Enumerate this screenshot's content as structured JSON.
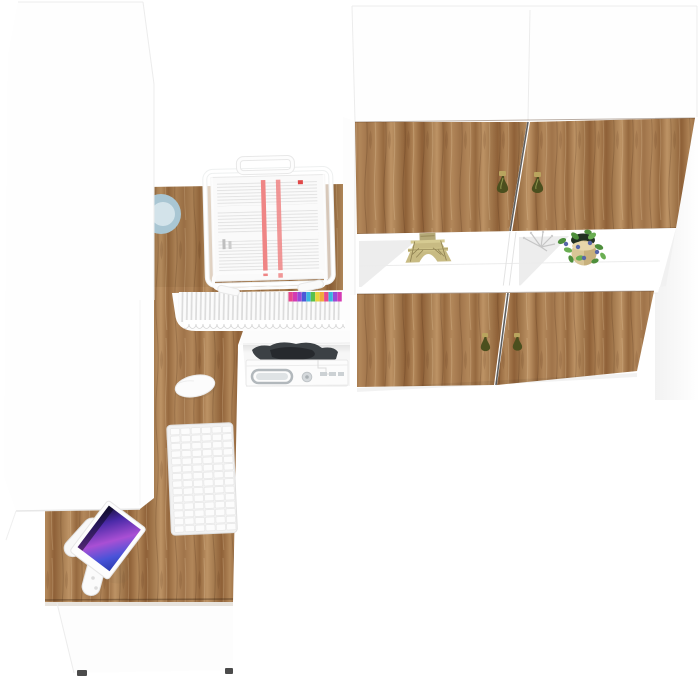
{
  "scene": {
    "description": "Top-down 3D product render of a white and oak home-office furniture set: corner desk with hutch, tall white cabinet and wall cabinet unit",
    "background": "#ffffff"
  },
  "colors": {
    "faintLine": "#ececec",
    "gapLine": "#5f5f5f",
    "handleBody": "#4b4f1e",
    "handleMount": "#b9a45e",
    "teal": "#a9c6d3",
    "tealInner": "#d3e3ea",
    "chair": "#3c4145",
    "chairDark": "#26292d",
    "metal": "#b2b8bc",
    "metalFill": "#dfe3e5",
    "redStripe": "#ef8585",
    "leaf": "#4e8f3c",
    "leaf2": "#6aae52",
    "berry": "#5766a8",
    "pot": "#d9c697",
    "potShade": "#c3ab77",
    "eiffel": "#c8bb83",
    "eiffelDark": "#8e8050",
    "foot": "#4b4b4b",
    "wire": "#c6c6c6"
  },
  "gradients": {
    "woodG": [
      {
        "o": 0,
        "c": "#a0744a"
      },
      {
        "o": 0.18,
        "c": "#b2875a"
      },
      {
        "o": 0.34,
        "c": "#96693f"
      },
      {
        "o": 0.5,
        "c": "#bd9365"
      },
      {
        "o": 0.66,
        "c": "#a47a4e"
      },
      {
        "o": 0.82,
        "c": "#8f6138"
      },
      {
        "o": 1,
        "c": "#b28759"
      }
    ],
    "screenG": [
      {
        "o": 0,
        "c": "#140f33"
      },
      {
        "o": 0.25,
        "c": "#4a2aa8"
      },
      {
        "o": 0.55,
        "c": "#a94fd4"
      },
      {
        "o": 0.8,
        "c": "#4853d8"
      },
      {
        "o": 1,
        "c": "#2b3bb0"
      }
    ],
    "bgShadow": [
      {
        "o": 0,
        "c": "rgba(0,0,0,0.05)"
      },
      {
        "o": 1,
        "c": "rgba(0,0,0,0)"
      }
    ],
    "cubbyShadow": [
      {
        "o": 0,
        "c": "rgba(0,0,0,0.08)"
      },
      {
        "o": 1,
        "c": "rgba(0,0,0,0)"
      }
    ]
  },
  "files": {
    "tabs": [
      "#e8488e",
      "#d43bb4",
      "#9a4ad8",
      "#4a58d8",
      "#3bb4e0",
      "#58c04a",
      "#e8d43b",
      "#f2a93b",
      "#e8488e",
      "#3bb4e0",
      "#9a4ad8",
      "#d43bb4"
    ]
  },
  "keyboard": {
    "rows": 14,
    "cols": 6
  },
  "objects": {
    "tall_cabinet": "Tall white cabinet",
    "wall_unit": "Wall-mounted cabinet unit with oak doors",
    "upper_door_left": "Upper oak door left",
    "upper_door_right": "Upper oak door right",
    "lower_door_left": "Lower oak door left",
    "lower_door_right": "Lower oak door right",
    "open_shelf": "Open display shelf",
    "eiffel_figurine": "Brass Eiffel Tower figurine",
    "potted_plant": "Potted plant with blue berries",
    "wire_ornament": "Silver wire ornament",
    "desk": "Oak corner desk",
    "hutch_shelf": "Desk hutch top shelf",
    "document_tray": "White wire document tray with papers",
    "file_folders": "File folders with colored index tabs",
    "printer": "White printer in desk cubby",
    "office_chair": "Dark office chair tucked under desk",
    "monitor": "Monitor on articulated arm",
    "monitor_arm": "White articulated monitor arm",
    "keyboard": "White wireless keyboard",
    "mouse": "White wireless mouse",
    "pedestal": "White desk pedestal with feet",
    "teal_object": "Teal round object beside cabinet",
    "door_handle": "Olive teardrop door handle"
  }
}
